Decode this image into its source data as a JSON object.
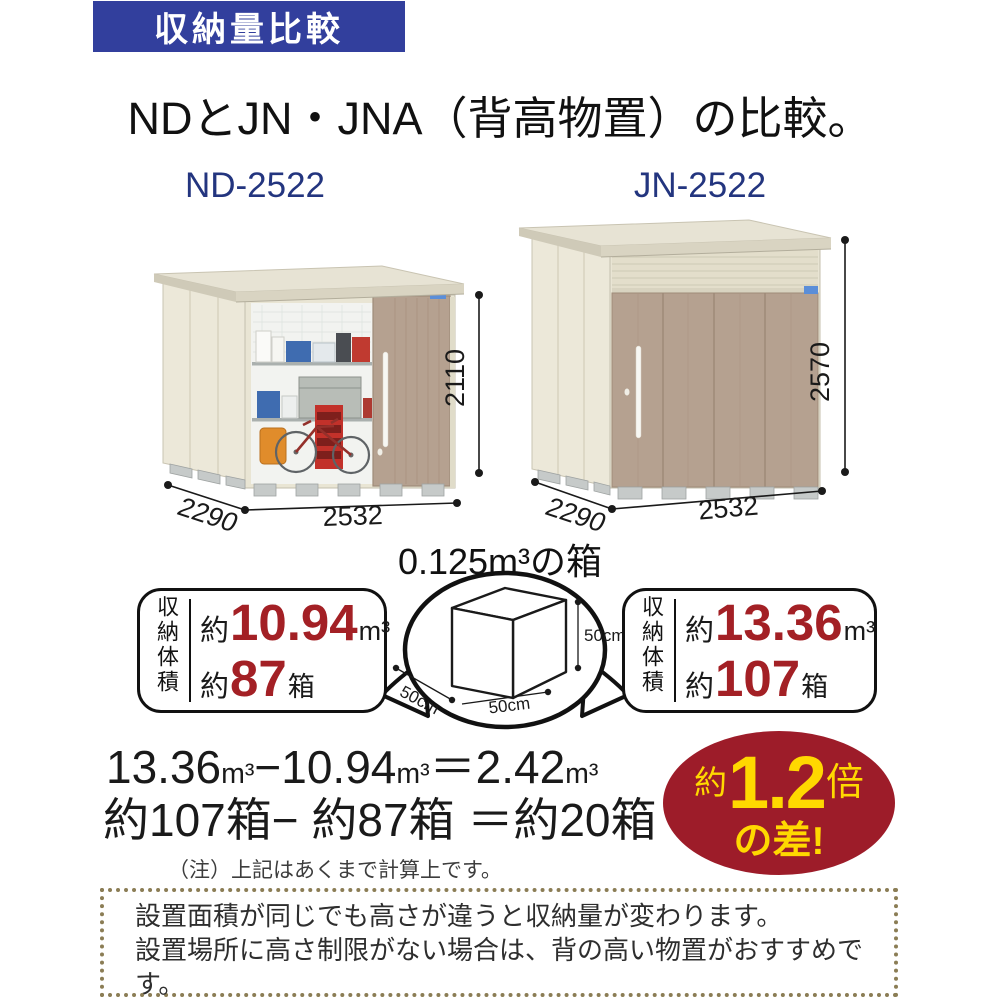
{
  "banner": {
    "title": "収納量比較"
  },
  "heading": "NDとJN・JNA（背高物置）の比較。",
  "sheds": {
    "left": {
      "model": "ND-2522",
      "height": "2110",
      "depth": "2290",
      "width": "2532"
    },
    "right": {
      "model": "JN-2522",
      "height": "2570",
      "depth": "2290",
      "width": "2532"
    }
  },
  "box_ref": {
    "title": "0.125m³の箱",
    "height_label": "50cm",
    "width_label": "50cm",
    "depth_label": "50cm"
  },
  "capacity": {
    "axis_label": "収納体積",
    "left": {
      "volume_prefix": "約",
      "volume_value": "10.94",
      "volume_unit": "m³",
      "boxes_prefix": "約",
      "boxes_value": "87",
      "boxes_unit": "箱"
    },
    "right": {
      "volume_prefix": "約",
      "volume_value": "13.36",
      "volume_unit": "m³",
      "boxes_prefix": "約",
      "boxes_value": "107",
      "boxes_unit": "箱"
    }
  },
  "calculation": {
    "line1_runs": [
      {
        "text": "13.36"
      },
      {
        "text": "m³",
        "cls": "unit"
      },
      {
        "text": "−"
      },
      {
        "text": "10.94"
      },
      {
        "text": "m³",
        "cls": "unit"
      },
      {
        "text": "＝"
      },
      {
        "text": "2.42"
      },
      {
        "text": "m³",
        "cls": "unit"
      }
    ],
    "line2": "約107箱− 約87箱 ＝約20箱",
    "note": "（注）上記はあくまで計算上です。"
  },
  "difference_badge": {
    "prefix": "約",
    "value": "1.2",
    "suffix": "倍",
    "line2": "の差!"
  },
  "footer": {
    "lines": [
      "設置面積が同じでも高さが違うと収納量が変わります。",
      "設置場所に高さ制限がない場合は、背の高い物置がおすすめです。",
      "土地を有効に活用できより経済的です。"
    ]
  },
  "colors": {
    "banner_bg": "#323f9d",
    "model_label": "#23357f",
    "accent_red": "#a32025",
    "badge_bg": "#9d1c29",
    "badge_text": "#ffd800",
    "footer_dots": "#8b7d55",
    "shed_wall": "#ece8d9",
    "shed_door": "#b5a190"
  }
}
